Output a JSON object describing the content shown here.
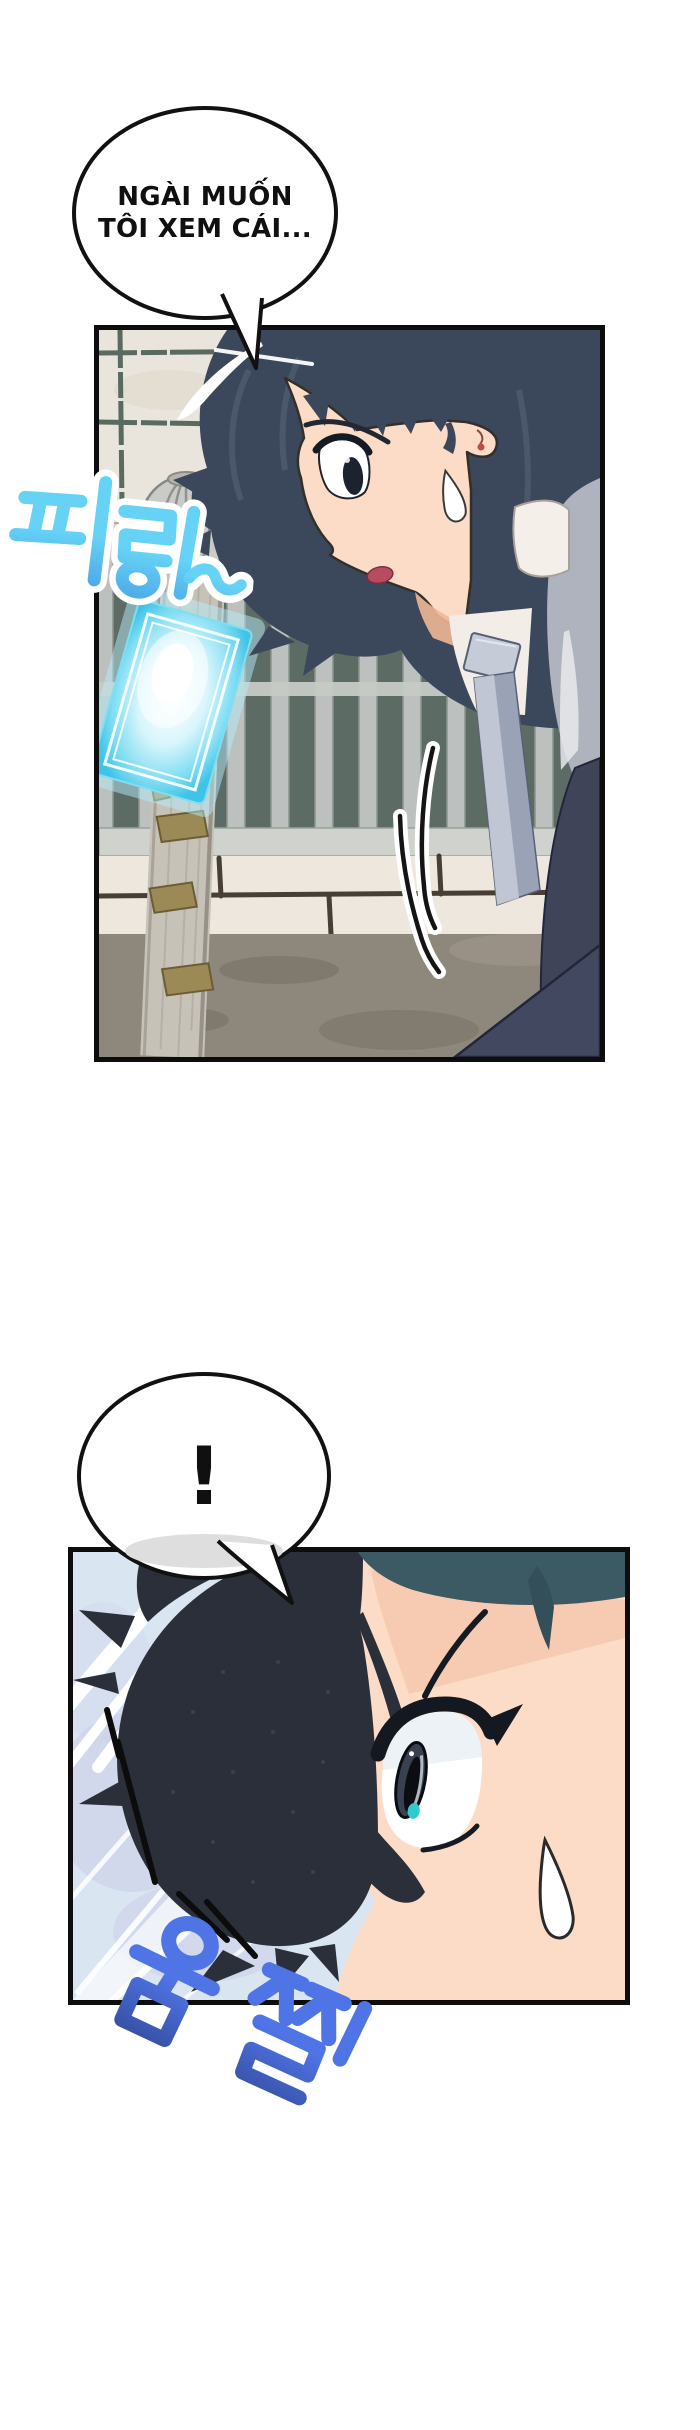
{
  "speech_bubbles": {
    "bubble1": {
      "line1": "NGÀI MUỐN",
      "line2": "TÔI XEM CÁI..."
    },
    "bubble2": {
      "text": "!"
    }
  },
  "sound_effects": {
    "sfx_ring": {
      "text": "피링~",
      "gradient_top": "#66d3f6",
      "gradient_bottom": "#1c55cc",
      "outline": "#ffffff"
    },
    "sfx_flinch": {
      "text": "움찔",
      "gradient_top": "#4f74e6",
      "gradient_bottom": "#0a0f2b"
    }
  },
  "palette": {
    "page_background": "#ffffff",
    "panel_border": "#0d0d0d",
    "wall": "#eae5dc",
    "wall_grid": "#40564c",
    "fence_background": "#5c6b64",
    "fence_bar": "#bcc0be",
    "block_wall": "#eee7de",
    "ground": "#8e877c",
    "pole": "#c7c2b8",
    "pole_bracket": "#9b8a55",
    "phone_glow": "#46c6e8",
    "hair_panel1": "#3b475a",
    "hair_panel2": "#2b2f3a",
    "hair_teal": "#3c5a64",
    "skin": "#fcdcc6",
    "skin_shadow": "#f3bf9f",
    "tie": "#9aa3b6",
    "jacket_dark": "#3f4459",
    "jacket_light": "#aeb3bd",
    "speedline_background": "#d9e6f2",
    "eye_glint": "#2fc9ce"
  }
}
